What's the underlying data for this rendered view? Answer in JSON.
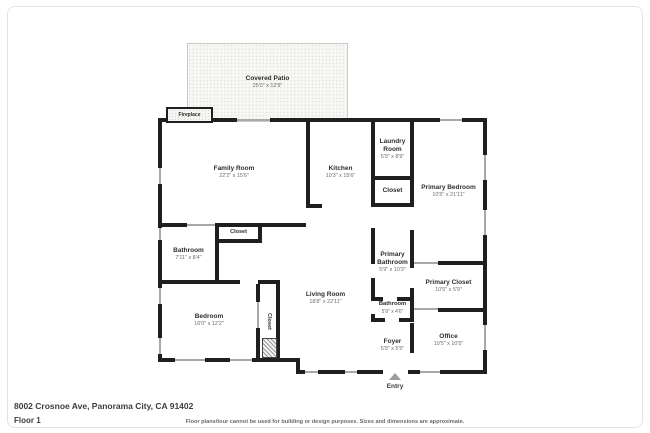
{
  "page": {
    "address": "8002 Crosnoe Ave, Panorama City, CA 91402",
    "floor_label": "Floor 1",
    "disclaimer": "Floor plans/tour cannot be used for building or design purposes. Sizes and dimensions are approximate."
  },
  "entry": {
    "label": "Entry"
  },
  "colors": {
    "wall": "#1f1f1f",
    "window_marker": "#a8a8a8",
    "room_name_text": "#2e2e2e",
    "room_dim_text": "#6b6b6b",
    "patio_border": "#c9c9c5"
  },
  "rooms": {
    "covered_patio": {
      "name": "Covered Patio",
      "dims": "25'0\" x 12'9\""
    },
    "fireplace": {
      "name": "Fireplace"
    },
    "family_room": {
      "name": "Family Room",
      "dims": "22'2\" x 15'6\""
    },
    "kitchen": {
      "name": "Kitchen",
      "dims": "10'3\" x 15'6\""
    },
    "laundry_room": {
      "name": "Laundry Room",
      "dims": "5'9\" x 8'9\""
    },
    "laundry_closet": {
      "name": "Closet"
    },
    "primary_bedroom": {
      "name": "Primary Bedroom",
      "dims": "10'5\" x 21'11\""
    },
    "bathroom_left": {
      "name": "Bathroom",
      "dims": "7'11\" x 8'4\""
    },
    "hall_closet": {
      "name": "Closet"
    },
    "bedroom": {
      "name": "Bedroom",
      "dims": "16'0\" x 12'2\""
    },
    "bedroom_closet": {
      "name": "Closet"
    },
    "living_room": {
      "name": "Living Room",
      "dims": "18'8\" x 22'11\""
    },
    "primary_bathroom": {
      "name": "Primary Bathroom",
      "dims": "5'9\" x 10'3\""
    },
    "bathroom_small": {
      "name": "Bathroom",
      "dims": "5'9\" x 4'6\""
    },
    "primary_closet": {
      "name": "Primary Closet",
      "dims": "10'5\" x 5'9\""
    },
    "office": {
      "name": "Office",
      "dims": "10'5\" x 10'5\""
    },
    "foyer": {
      "name": "Foyer",
      "dims": "5'9\" x 5'5\""
    }
  }
}
